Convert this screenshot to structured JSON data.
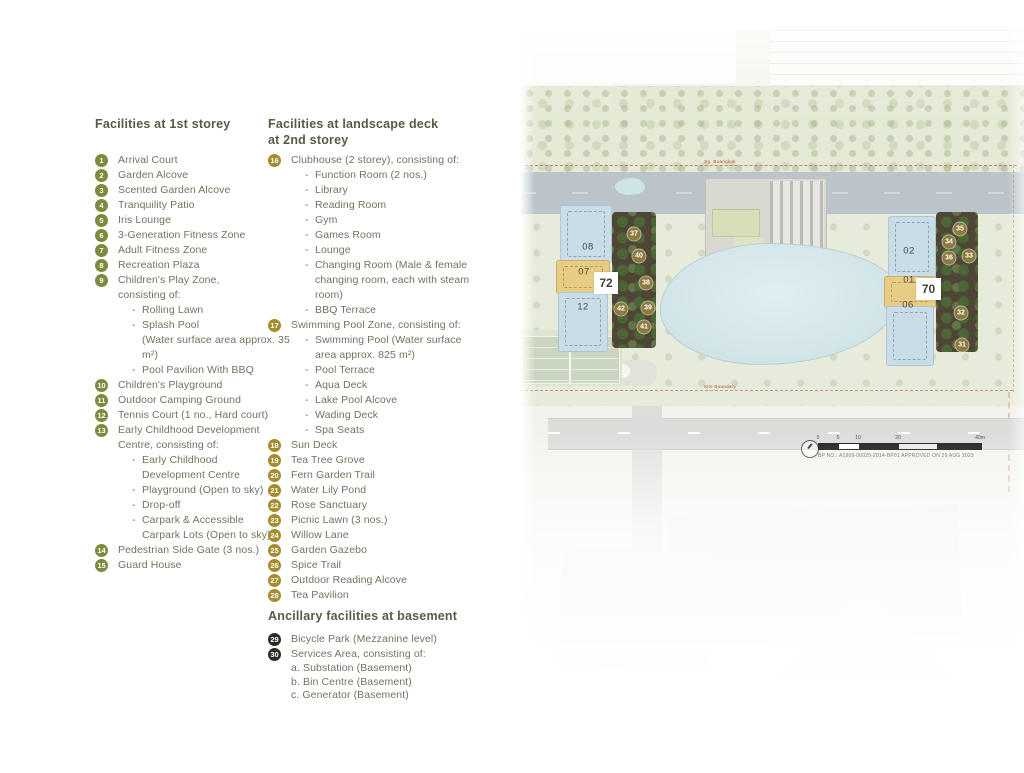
{
  "ui": {
    "sub_bullet": "-"
  },
  "legend": {
    "sections": [
      {
        "title": "Facilities at 1st storey",
        "circle_color": "#7d8b3e",
        "items": [
          {
            "num": "1",
            "label": "Arrival Court"
          },
          {
            "num": "2",
            "label": "Garden Alcove"
          },
          {
            "num": "3",
            "label": "Scented Garden Alcove"
          },
          {
            "num": "4",
            "label": "Tranquility Patio"
          },
          {
            "num": "5",
            "label": "Iris Lounge"
          },
          {
            "num": "6",
            "label": "3-Generation Fitness Zone"
          },
          {
            "num": "7",
            "label": "Adult Fitness Zone"
          },
          {
            "num": "8",
            "label": "Recreation Plaza"
          },
          {
            "num": "9",
            "label": "Children's Play Zone,\nconsisting of:",
            "subs": [
              "Rolling Lawn",
              "Splash Pool\n(Water surface area approx. 35 m²)",
              "Pool Pavilion With BBQ"
            ]
          },
          {
            "num": "10",
            "label": "Children's Playground"
          },
          {
            "num": "11",
            "label": "Outdoor Camping Ground"
          },
          {
            "num": "12",
            "label": "Tennis Court (1 no., Hard court)"
          },
          {
            "num": "13",
            "label": "Early Childhood Development\nCentre, consisting of:",
            "subs": [
              "Early Childhood\nDevelopment Centre",
              "Playground (Open to sky)",
              "Drop-off",
              "Carpark & Accessible\nCarpark Lots (Open to sky)"
            ]
          },
          {
            "num": "14",
            "label": "Pedestrian Side Gate (3 nos.)"
          },
          {
            "num": "15",
            "label": "Guard House"
          }
        ]
      },
      {
        "title": "Facilities at landscape deck\nat 2nd storey",
        "circle_color": "#a68c2e",
        "items": [
          {
            "num": "16",
            "label": "Clubhouse (2 storey), consisting of:",
            "subs": [
              "Function Room (2 nos.)",
              "Library",
              "Reading Room",
              "Gym",
              "Games Room",
              "Lounge",
              "Changing Room (Male & female\nchanging room, each with steam room)",
              "BBQ Terrace"
            ]
          },
          {
            "num": "17",
            "label": "Swimming Pool Zone, consisting of:",
            "subs": [
              "Swimming Pool (Water surface\narea approx. 825 m²)",
              "Pool Terrace",
              "Aqua Deck",
              "Lake Pool Alcove",
              "Wading Deck",
              "Spa Seats"
            ]
          },
          {
            "num": "18",
            "label": "Sun Deck"
          },
          {
            "num": "19",
            "label": "Tea Tree Grove"
          },
          {
            "num": "20",
            "label": "Fern Garden Trail"
          },
          {
            "num": "21",
            "label": "Water Lily Pond"
          },
          {
            "num": "22",
            "label": "Rose Sanctuary"
          },
          {
            "num": "23",
            "label": "Picnic Lawn (3 nos.)"
          },
          {
            "num": "24",
            "label": "Willow Lane"
          },
          {
            "num": "25",
            "label": "Garden Gazebo"
          },
          {
            "num": "26",
            "label": "Spice Trail"
          },
          {
            "num": "27",
            "label": "Outdoor Reading Alcove"
          },
          {
            "num": "28",
            "label": "Tea Pavilion"
          }
        ]
      },
      {
        "title": "Ancillary facilities at basement",
        "circle_color": "#2e2b26",
        "items": [
          {
            "num": "29",
            "label": "Bicycle Park (Mezzanine level)"
          },
          {
            "num": "30",
            "label": "Services Area, consisting of:",
            "lines": [
              "a. Substation (Basement)",
              "b. Bin Centre (Basement)",
              "c. Generator (Basement)"
            ]
          }
        ]
      },
      {
        "title": "Facilities at roof garden,\nat 40th storey of block 72",
        "circle_color": "#8d7b3c",
        "items": [
          {
            "num": "37",
            "label": "Juniper Lounge"
          },
          {
            "num": "38",
            "label": "Hammock Deck"
          },
          {
            "num": "39",
            "label": "Horizon Terrace"
          },
          {
            "num": "40",
            "label": "Stargazing Deck"
          },
          {
            "num": "41",
            "label": "Sky Dining Terrace With BBQ"
          },
          {
            "num": "42",
            "label": "Accessible Toilet"
          }
        ]
      },
      {
        "title": "Facilities at roof garden,\nat 40th storey of block 70",
        "circle_color": "#8d7b3c",
        "items": [
          {
            "num": "31",
            "label": "Outdoor Reading Lounge"
          },
          {
            "num": "32",
            "label": "Yoga Lawn"
          },
          {
            "num": "33",
            "label": "Sunset Terrace"
          },
          {
            "num": "34",
            "label": "Scented Garden"
          },
          {
            "num": "35",
            "label": "Alfresco Dining With BBQ"
          },
          {
            "num": "36",
            "label": "Accessible Toilet"
          }
        ]
      }
    ]
  },
  "map": {
    "colors": {
      "marker": "#8d7b3c",
      "unit_blue": "#c8dde8",
      "unit_tan": "#e8cc84",
      "deck_brown": "#4e4536",
      "pool": "#cfe3e6",
      "boundary": "#bf4a2e"
    },
    "blocks": [
      {
        "chip": "72",
        "units": [
          "08",
          "07",
          "12"
        ]
      },
      {
        "chip": "70",
        "units": [
          "02",
          "01",
          "06"
        ]
      }
    ],
    "unit_labels": [
      {
        "t": "08",
        "x": 68,
        "y": 217
      },
      {
        "t": "07",
        "x": 64,
        "y": 242
      },
      {
        "t": "12",
        "x": 63,
        "y": 277
      },
      {
        "t": "02",
        "x": 389,
        "y": 221
      },
      {
        "t": "01",
        "x": 389,
        "y": 250
      },
      {
        "t": "06",
        "x": 388,
        "y": 275
      }
    ],
    "markers": [
      {
        "n": "37",
        "x": 114,
        "y": 204
      },
      {
        "n": "40",
        "x": 119,
        "y": 226
      },
      {
        "n": "38",
        "x": 126,
        "y": 253
      },
      {
        "n": "42",
        "x": 101,
        "y": 279
      },
      {
        "n": "39",
        "x": 128,
        "y": 278
      },
      {
        "n": "41",
        "x": 124,
        "y": 297
      },
      {
        "n": "35",
        "x": 440,
        "y": 199
      },
      {
        "n": "34",
        "x": 429,
        "y": 212
      },
      {
        "n": "36",
        "x": 429,
        "y": 228
      },
      {
        "n": "33",
        "x": 449,
        "y": 226
      },
      {
        "n": "32",
        "x": 441,
        "y": 283
      },
      {
        "n": "31",
        "x": 442,
        "y": 315
      }
    ],
    "boundary_label_top": "Sg. Buangkok",
    "boundary_label_bottom": "Site Boundary",
    "scale_ticks": [
      {
        "label": "0",
        "x": 0
      },
      {
        "label": "5",
        "x": 20
      },
      {
        "label": "10",
        "x": 40
      },
      {
        "label": "20",
        "x": 80
      },
      {
        "label": "40m",
        "x": 162
      }
    ],
    "bp_text": "BP NO.: A1909-00025-2014-BP01 APPROVED ON 29 AUG 2023"
  }
}
